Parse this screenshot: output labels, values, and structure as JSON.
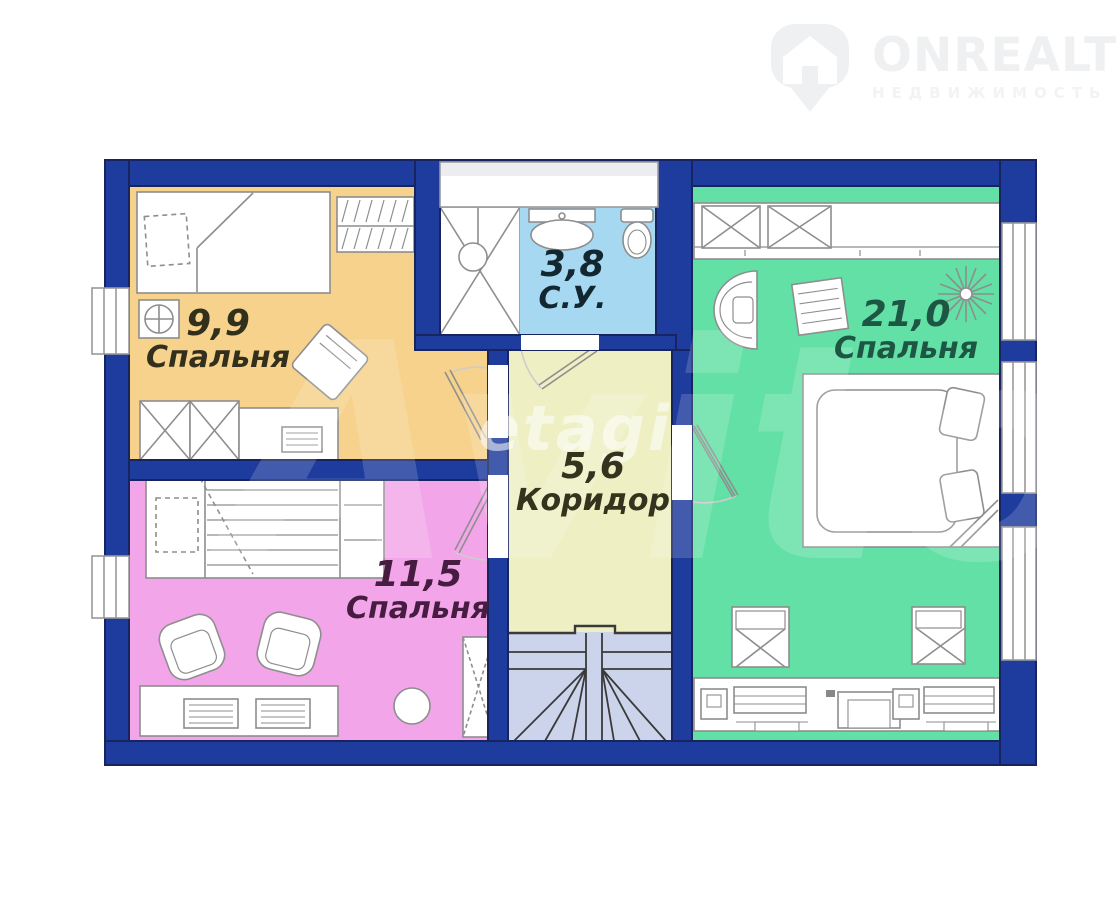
{
  "brand": {
    "name": "ONREALT",
    "tagline": "НЕДВИЖИМОСТЬ",
    "icon": "location-pin-house-icon",
    "color": "#eff0f2"
  },
  "watermarks": {
    "large": "Avito",
    "small": "etagi"
  },
  "plan": {
    "type": "floor-plan",
    "wall_color": "#1e3c9e",
    "stairs_color": "#ccd4ec",
    "rooms": [
      {
        "key": "bedroom-top-left",
        "area": "9,9",
        "name": "Спальня",
        "fill": "#f6d28c",
        "text_color": "#32301c"
      },
      {
        "key": "bathroom",
        "area": "3,8",
        "name": "С.У.",
        "fill": "#a6d9f1",
        "text_color": "#132730"
      },
      {
        "key": "corridor",
        "area": "5,6",
        "name": "Коридор",
        "fill": "#eef0c4",
        "text_color": "#34331d"
      },
      {
        "key": "bedroom-bottom-left",
        "area": "11,5",
        "name": "Спальня",
        "fill": "#f2a6e9",
        "text_color": "#461c40"
      },
      {
        "key": "bedroom-right",
        "area": "21,0",
        "name": "Спальня",
        "fill": "#63e0a5",
        "text_color": "#1d5744"
      }
    ]
  }
}
